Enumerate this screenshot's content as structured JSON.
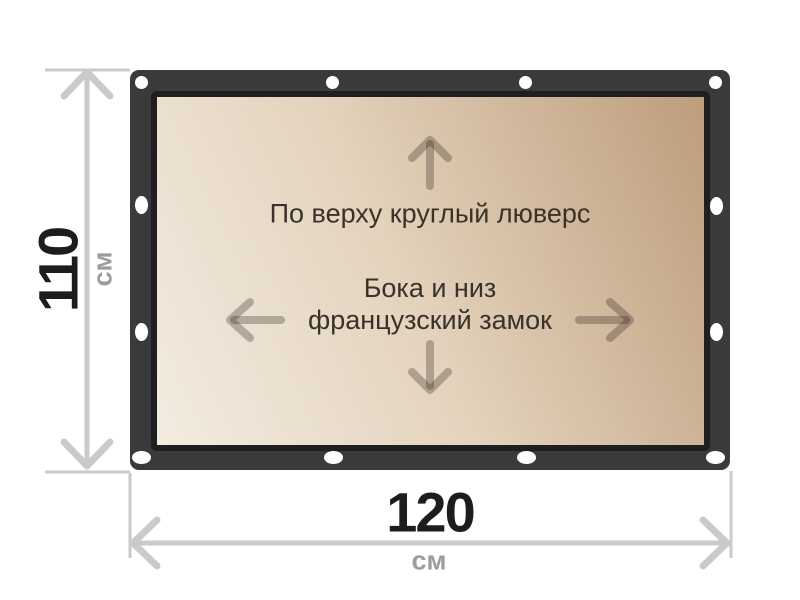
{
  "diagram": {
    "panel_labels": {
      "top": "По верху круглый люверс",
      "middle_line1": "Бока и низ",
      "middle_line2": "французский замок"
    },
    "height_dimension": {
      "value": "110",
      "unit": "см"
    },
    "width_dimension": {
      "value": "120",
      "unit": "см"
    },
    "arrows": [
      "up",
      "left",
      "right",
      "down"
    ],
    "grommet_count": 12,
    "colors": {
      "frame": "#3a3a3c",
      "frame_inner_border": "#1f1f22",
      "panel_gradient_light": "#f3ece1",
      "panel_gradient_mid": "#e4d3bd",
      "panel_gradient_dark": "#bd9d7c",
      "grommet": "#ffffff",
      "dimension_line": "#cacaca",
      "dimension_value_text": "#1d1d1d",
      "dimension_unit_text": "#9c9c9c",
      "panel_text": "#38322a"
    }
  }
}
